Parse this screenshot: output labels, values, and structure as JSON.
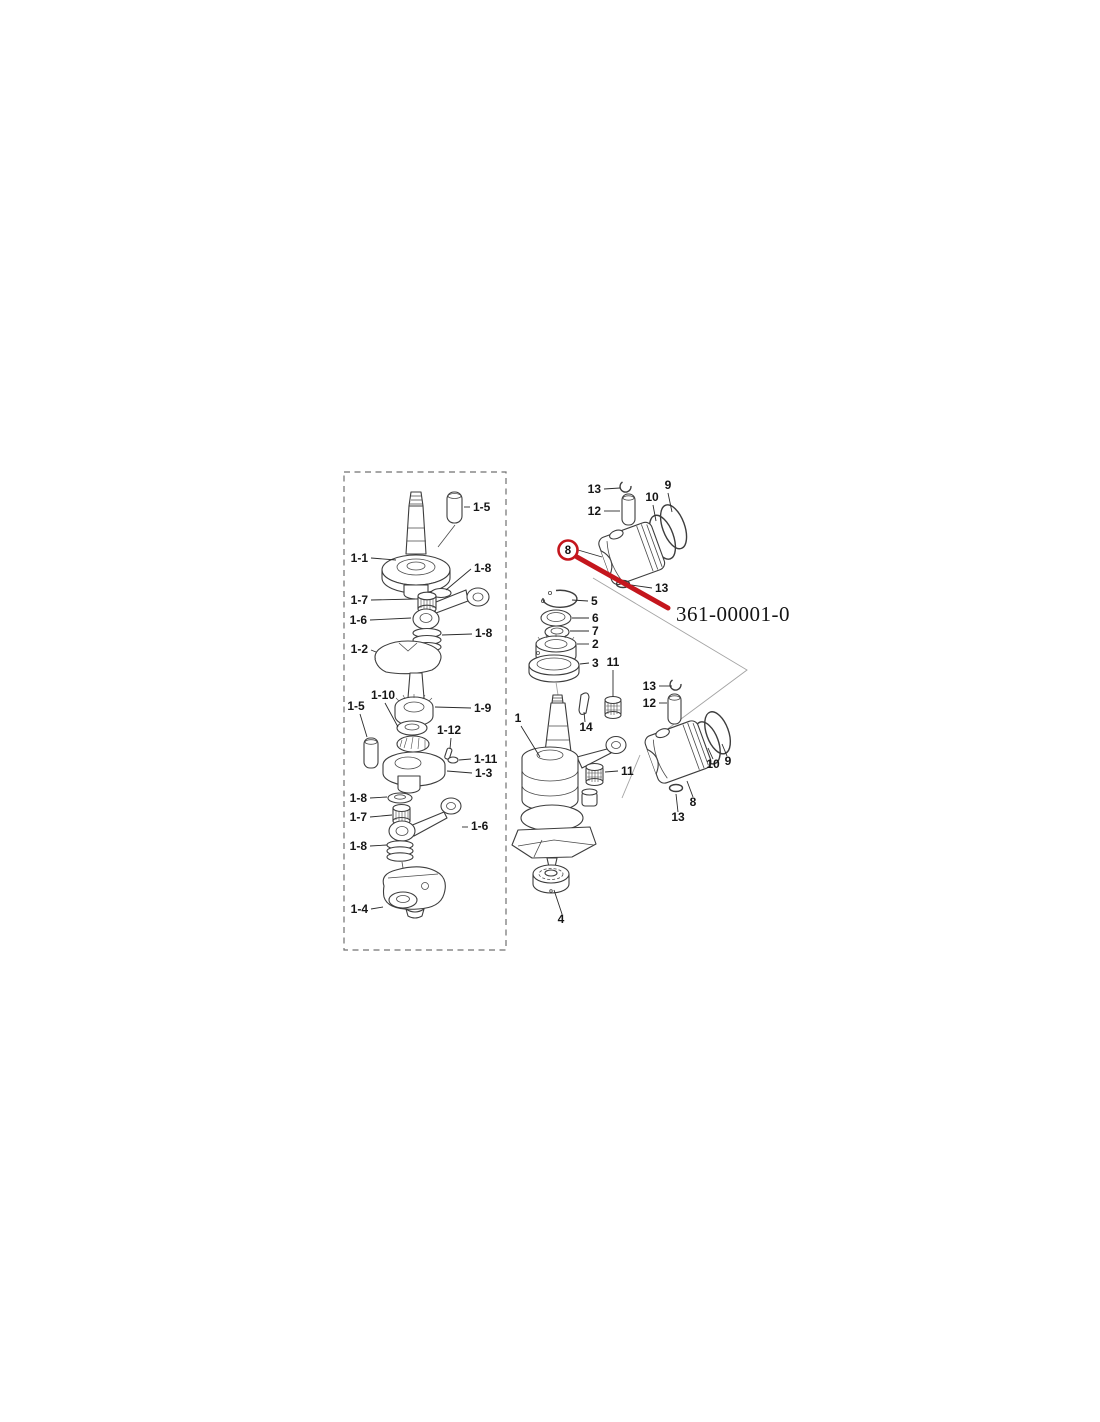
{
  "page": {
    "background": "#ffffff"
  },
  "annotation": {
    "circled_label": "8",
    "part_number": "361-00001-0",
    "red_color": "#c4161d"
  },
  "callout_groups": [
    {
      "layer": "callouts-left",
      "items": [
        {
          "text": "1-5",
          "x": 473,
          "y": 511,
          "anchor": "start",
          "leader": [
            470,
            507,
            464,
            507
          ]
        },
        {
          "text": "1-1",
          "x": 368,
          "y": 562,
          "anchor": "end",
          "leader": [
            371,
            558,
            396,
            560
          ]
        },
        {
          "text": "1-8",
          "x": 474,
          "y": 572,
          "anchor": "start",
          "leader": [
            471,
            569,
            446,
            590
          ]
        },
        {
          "text": "1-7",
          "x": 368,
          "y": 604,
          "anchor": "end",
          "leader": [
            371,
            600,
            415,
            599
          ]
        },
        {
          "text": "1-6",
          "x": 367,
          "y": 624,
          "anchor": "end",
          "leader": [
            370,
            620,
            411,
            618
          ]
        },
        {
          "text": "1-8",
          "x": 475,
          "y": 637,
          "anchor": "start",
          "leader": [
            472,
            634,
            442,
            635
          ]
        },
        {
          "text": "1-2",
          "x": 368,
          "y": 653,
          "anchor": "end",
          "leader": [
            371,
            650,
            376,
            652
          ]
        },
        {
          "text": "1-10",
          "x": 383,
          "y": 699,
          "anchor": "middle",
          "leader": [
            385,
            703,
            398,
            727
          ]
        },
        {
          "text": "1-5",
          "x": 356,
          "y": 710,
          "anchor": "middle",
          "leader": [
            360,
            714,
            367,
            737
          ]
        },
        {
          "text": "1-9",
          "x": 474,
          "y": 712,
          "anchor": "start",
          "leader": [
            471,
            708,
            435,
            707
          ]
        },
        {
          "text": "1-12",
          "x": 449,
          "y": 734,
          "anchor": "middle",
          "leader": [
            451,
            738,
            450,
            749
          ]
        },
        {
          "text": "1-11",
          "x": 474,
          "y": 763,
          "anchor": "start",
          "leader": [
            471,
            759,
            459,
            760
          ]
        },
        {
          "text": "1-3",
          "x": 475,
          "y": 777,
          "anchor": "start",
          "leader": [
            472,
            773,
            447,
            771
          ]
        },
        {
          "text": "1-8",
          "x": 367,
          "y": 802,
          "anchor": "end",
          "leader": [
            370,
            798,
            387,
            797
          ]
        },
        {
          "text": "1-7",
          "x": 367,
          "y": 821,
          "anchor": "end",
          "leader": [
            370,
            817,
            392,
            815
          ]
        },
        {
          "text": "1-6",
          "x": 471,
          "y": 830,
          "anchor": "start",
          "leader": [
            468,
            827,
            462,
            827
          ]
        },
        {
          "text": "1-8",
          "x": 367,
          "y": 850,
          "anchor": "end",
          "leader": [
            370,
            846,
            387,
            845
          ]
        },
        {
          "text": "1-4",
          "x": 368,
          "y": 913,
          "anchor": "end",
          "leader": [
            371,
            909,
            383,
            907
          ]
        }
      ]
    },
    {
      "layer": "callouts-right",
      "items": [
        {
          "text": "13",
          "x": 601,
          "y": 493,
          "anchor": "end",
          "leader": [
            604,
            489,
            620,
            488
          ]
        },
        {
          "text": "12",
          "x": 601,
          "y": 515,
          "anchor": "end",
          "leader": [
            604,
            511,
            620,
            511
          ]
        },
        {
          "text": "10",
          "x": 652,
          "y": 501,
          "anchor": "middle",
          "leader": [
            653,
            505,
            656,
            521
          ]
        },
        {
          "text": "9",
          "x": 668,
          "y": 489,
          "anchor": "middle",
          "leader": [
            668,
            493,
            672,
            512
          ]
        },
        {
          "text": "13",
          "x": 655,
          "y": 592,
          "anchor": "start",
          "leader": [
            652,
            588,
            631,
            585
          ]
        },
        {
          "text": "5",
          "x": 591,
          "y": 605,
          "anchor": "start",
          "leader": [
            588,
            601,
            572,
            600
          ]
        },
        {
          "text": "6",
          "x": 592,
          "y": 622,
          "anchor": "start",
          "leader": [
            589,
            618,
            572,
            618
          ]
        },
        {
          "text": "7",
          "x": 592,
          "y": 635,
          "anchor": "start",
          "leader": [
            589,
            631,
            570,
            631
          ]
        },
        {
          "text": "2",
          "x": 592,
          "y": 648,
          "anchor": "start",
          "leader": [
            589,
            644,
            577,
            644
          ]
        },
        {
          "text": "3",
          "x": 592,
          "y": 667,
          "anchor": "start",
          "leader": [
            589,
            663,
            580,
            664
          ]
        },
        {
          "text": "11",
          "x": 613,
          "y": 666,
          "anchor": "middle",
          "leader": [
            613,
            670,
            613,
            697
          ]
        },
        {
          "text": "1",
          "x": 518,
          "y": 722,
          "anchor": "middle",
          "leader": [
            521,
            726,
            540,
            757
          ]
        },
        {
          "text": "14",
          "x": 586,
          "y": 731,
          "anchor": "middle",
          "leader": [
            585,
            722,
            584,
            712
          ]
        },
        {
          "text": "11",
          "x": 621,
          "y": 775,
          "anchor": "start",
          "leader": [
            618,
            771,
            605,
            772
          ]
        },
        {
          "text": "4",
          "x": 561,
          "y": 923,
          "anchor": "middle",
          "leader": [
            562,
            914,
            554,
            890
          ]
        },
        {
          "text": "13",
          "x": 656,
          "y": 690,
          "anchor": "end",
          "leader": [
            659,
            686,
            672,
            686
          ]
        },
        {
          "text": "12",
          "x": 656,
          "y": 707,
          "anchor": "end",
          "leader": [
            659,
            703,
            667,
            703
          ]
        },
        {
          "text": "10",
          "x": 713,
          "y": 768,
          "anchor": "middle",
          "leader": [
            713,
            759,
            708,
            748
          ]
        },
        {
          "text": "9",
          "x": 728,
          "y": 765,
          "anchor": "middle",
          "leader": [
            727,
            756,
            722,
            744
          ]
        },
        {
          "text": "8",
          "x": 693,
          "y": 806,
          "anchor": "middle",
          "leader": [
            693,
            797,
            687,
            781
          ]
        },
        {
          "text": "13",
          "x": 678,
          "y": 821,
          "anchor": "middle",
          "leader": [
            678,
            812,
            676,
            794
          ]
        }
      ]
    }
  ]
}
